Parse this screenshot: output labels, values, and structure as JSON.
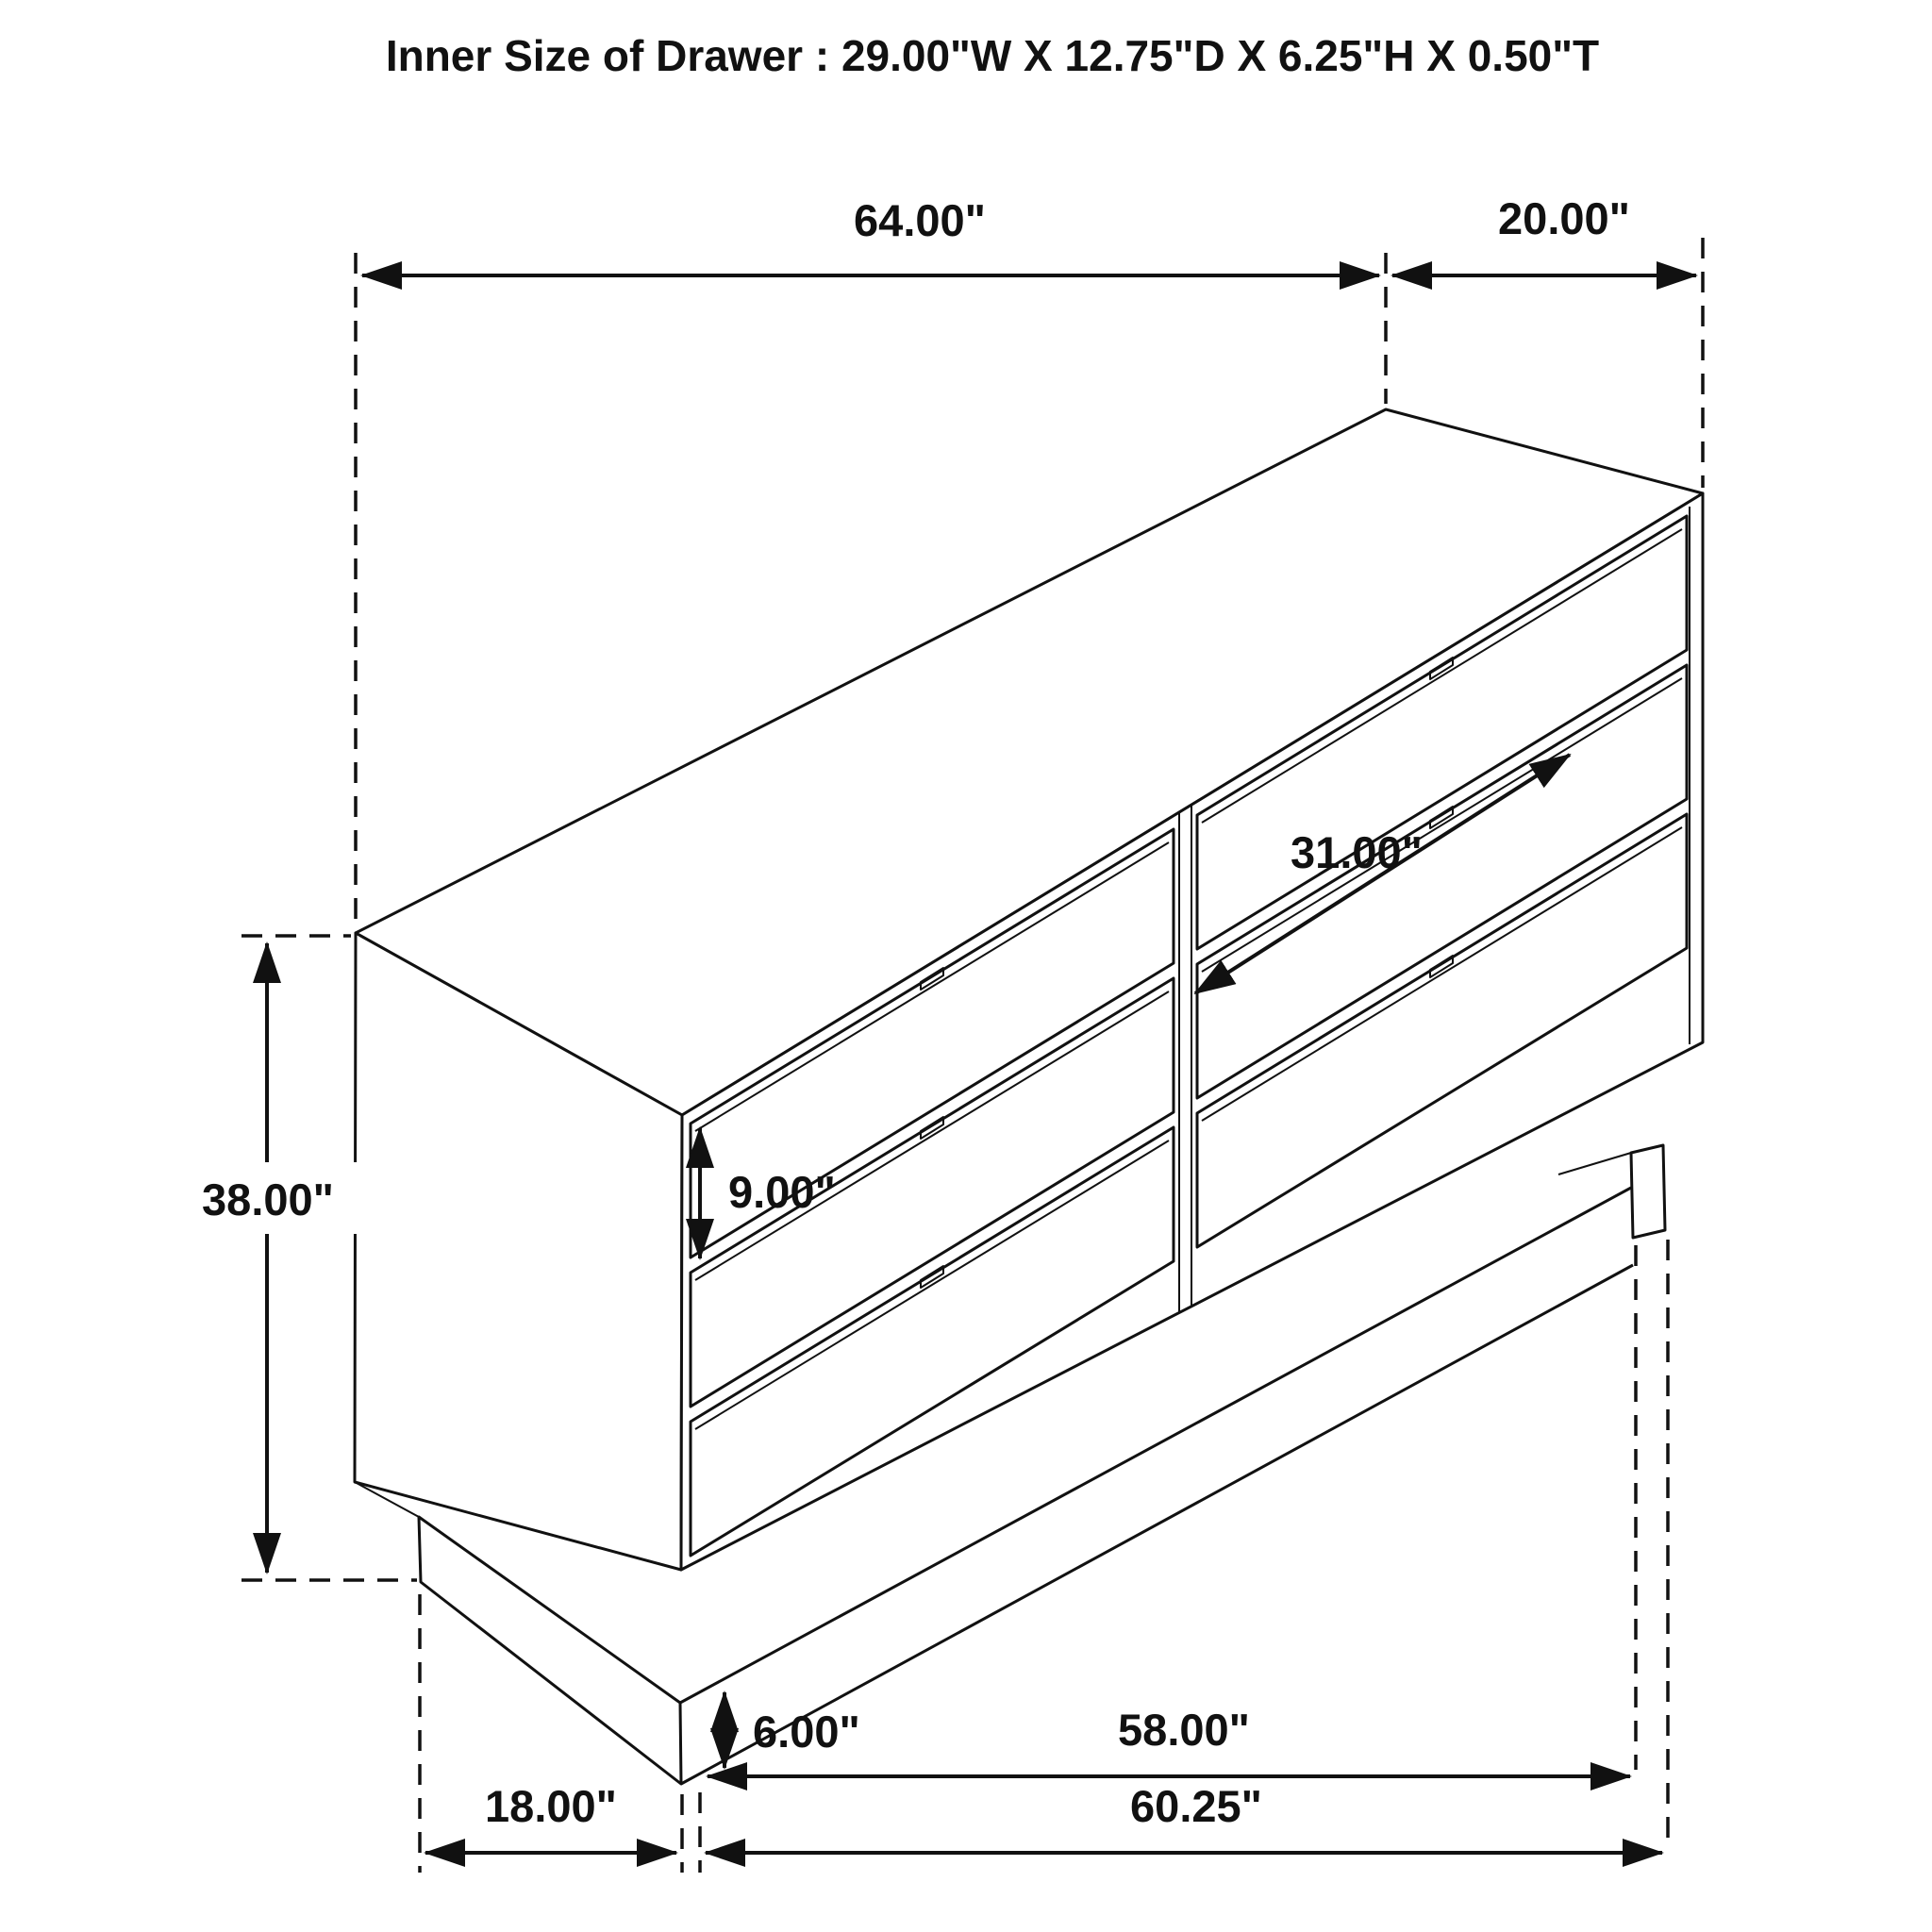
{
  "title": "Inner Size of Drawer : 29.00\"W X 12.75\"D X 6.25\"H X 0.50\"T",
  "figure": {
    "subject": "six-drawer dresser isometric dimension drawing",
    "drawer_rows": 3,
    "drawer_columns": 2,
    "line_color": "#111111",
    "background_color": "#ffffff"
  },
  "dims": {
    "top_width": "64.00\"",
    "top_depth": "20.00\"",
    "overall_height": "38.00\"",
    "drawer_front_height": "9.00\"",
    "drawer_width_diagonal": "31.00\"",
    "base_height": "6.00\"",
    "base_inner_span": "58.00\"",
    "base_width": "60.25\"",
    "base_side_depth": "18.00\""
  }
}
